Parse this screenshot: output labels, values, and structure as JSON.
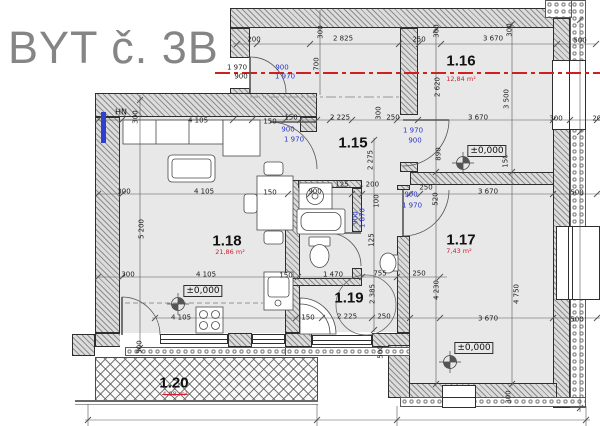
{
  "title": "BYT č. 3B",
  "level_marker_text": "±0,000",
  "colors": {
    "red_axis": "#cf1f1f",
    "dim_blue": "#2a35c8",
    "title_gray": "#858585",
    "area_red": "#cc2233"
  },
  "rooms": [
    {
      "id": "1.15",
      "x": 353,
      "y": 143
    },
    {
      "id": "1.16",
      "x": 461,
      "y": 61
    },
    {
      "id": "1.17",
      "x": 461,
      "y": 240
    },
    {
      "id": "1.18",
      "x": 227,
      "y": 241
    },
    {
      "id": "1.19",
      "x": 349,
      "y": 298
    },
    {
      "id": "1.20",
      "x": 174,
      "y": 383
    }
  ],
  "areas": [
    {
      "t": "12,84 m²",
      "x": 461,
      "y": 79
    },
    {
      "t": "7,43 m²",
      "x": 459,
      "y": 251
    },
    {
      "t": "21,86 m²",
      "x": 230,
      "y": 252
    },
    {
      "t": "4,98 m²",
      "x": 175,
      "y": 394,
      "struck": true
    }
  ],
  "levels": [
    {
      "bx": 203,
      "by": 291,
      "cx": 178,
      "cy": 304
    },
    {
      "bx": 487,
      "by": 151,
      "cx": 463,
      "cy": 163
    },
    {
      "bx": 474,
      "by": 348,
      "cx": 450,
      "cy": 362
    }
  ],
  "misc": [
    {
      "t": "HN",
      "x": 121,
      "y": 112
    }
  ],
  "dims": [
    {
      "t": "200",
      "x": 254,
      "y": 40
    },
    {
      "t": "300",
      "x": 321,
      "y": 32,
      "v": 1
    },
    {
      "t": "2 825",
      "x": 343,
      "y": 39
    },
    {
      "t": "250",
      "x": 419,
      "y": 40
    },
    {
      "t": "300",
      "x": 437,
      "y": 31,
      "v": 1
    },
    {
      "t": "3 670",
      "x": 493,
      "y": 39
    },
    {
      "t": "300",
      "x": 510,
      "y": 30,
      "v": 1
    },
    {
      "t": "500",
      "x": 580,
      "y": 41
    },
    {
      "t": "1 970",
      "x": 237,
      "y": 68
    },
    {
      "t": "900",
      "x": 282,
      "y": 68,
      "b": 1
    },
    {
      "t": "900",
      "x": 241,
      "y": 77
    },
    {
      "t": "1 970",
      "x": 285,
      "y": 77,
      "b": 1
    },
    {
      "t": "700",
      "x": 317,
      "y": 64,
      "v": 1
    },
    {
      "t": "2 620",
      "x": 438,
      "y": 87,
      "v": 1
    },
    {
      "t": "3 500",
      "x": 507,
      "y": 99,
      "v": 1
    },
    {
      "t": "4 105",
      "x": 198,
      "y": 121
    },
    {
      "t": "150",
      "x": 270,
      "y": 122
    },
    {
      "t": "300",
      "x": 136,
      "y": 117,
      "v": 1
    },
    {
      "t": "900",
      "x": 288,
      "y": 130,
      "b": 1
    },
    {
      "t": "1 970",
      "x": 294,
      "y": 140,
      "b": 1
    },
    {
      "t": "150",
      "x": 291,
      "y": 118
    },
    {
      "t": "2 225",
      "x": 340,
      "y": 118
    },
    {
      "t": "300",
      "x": 379,
      "y": 113,
      "v": 1
    },
    {
      "t": "250",
      "x": 393,
      "y": 118
    },
    {
      "t": "1 970",
      "x": 413,
      "y": 131,
      "b": 1
    },
    {
      "t": "900",
      "x": 415,
      "y": 141,
      "b": 1
    },
    {
      "t": "3 670",
      "x": 478,
      "y": 118
    },
    {
      "t": "300",
      "x": 556,
      "y": 119
    },
    {
      "t": "200",
      "x": 599,
      "y": 119
    },
    {
      "t": "2 275",
      "x": 371,
      "y": 160,
      "v": 1
    },
    {
      "t": "890",
      "x": 439,
      "y": 154,
      "v": 1
    },
    {
      "t": "150",
      "x": 506,
      "y": 161,
      "v": 1
    },
    {
      "t": "125",
      "x": 342,
      "y": 185
    },
    {
      "t": "1 200",
      "x": 369,
      "y": 185
    },
    {
      "t": "900",
      "x": 315,
      "y": 192
    },
    {
      "t": "100",
      "x": 377,
      "y": 201,
      "v": 1
    },
    {
      "t": "900",
      "x": 356,
      "y": 218,
      "v": 1,
      "b": 1
    },
    {
      "t": "1 870",
      "x": 363,
      "y": 218,
      "v": 1,
      "b": 1
    },
    {
      "t": "125",
      "x": 372,
      "y": 240,
      "v": 1
    },
    {
      "t": "250",
      "x": 426,
      "y": 188
    },
    {
      "t": "520",
      "x": 436,
      "y": 199,
      "v": 1
    },
    {
      "t": "900",
      "x": 411,
      "y": 195,
      "b": 1
    },
    {
      "t": "1 970",
      "x": 412,
      "y": 206,
      "b": 1
    },
    {
      "t": "3 670",
      "x": 488,
      "y": 192
    },
    {
      "t": "500",
      "x": 577,
      "y": 193
    },
    {
      "t": "300",
      "x": 124,
      "y": 192
    },
    {
      "t": "4 105",
      "x": 204,
      "y": 192
    },
    {
      "t": "150",
      "x": 270,
      "y": 193
    },
    {
      "t": "5 200",
      "x": 142,
      "y": 229,
      "v": 1
    },
    {
      "t": "300",
      "x": 128,
      "y": 275
    },
    {
      "t": "4 105",
      "x": 206,
      "y": 275
    },
    {
      "t": "150",
      "x": 286,
      "y": 276
    },
    {
      "t": "1 470",
      "x": 333,
      "y": 275
    },
    {
      "t": "755",
      "x": 380,
      "y": 274
    },
    {
      "t": "250",
      "x": 419,
      "y": 274
    },
    {
      "t": "4 230",
      "x": 437,
      "y": 290,
      "v": 1
    },
    {
      "t": "2 385",
      "x": 373,
      "y": 294,
      "v": 1
    },
    {
      "t": "4 750",
      "x": 517,
      "y": 294,
      "v": 1
    },
    {
      "t": "4 105",
      "x": 181,
      "y": 318
    },
    {
      "t": "150",
      "x": 308,
      "y": 318
    },
    {
      "t": "2 225",
      "x": 347,
      "y": 317
    },
    {
      "t": "250",
      "x": 384,
      "y": 317
    },
    {
      "t": "3 670",
      "x": 488,
      "y": 319
    },
    {
      "t": "500",
      "x": 577,
      "y": 320
    },
    {
      "t": "500",
      "x": 140,
      "y": 347,
      "v": 1
    },
    {
      "t": "500",
      "x": 381,
      "y": 352,
      "v": 1
    },
    {
      "t": "300",
      "x": 509,
      "y": 397,
      "v": 1
    }
  ]
}
